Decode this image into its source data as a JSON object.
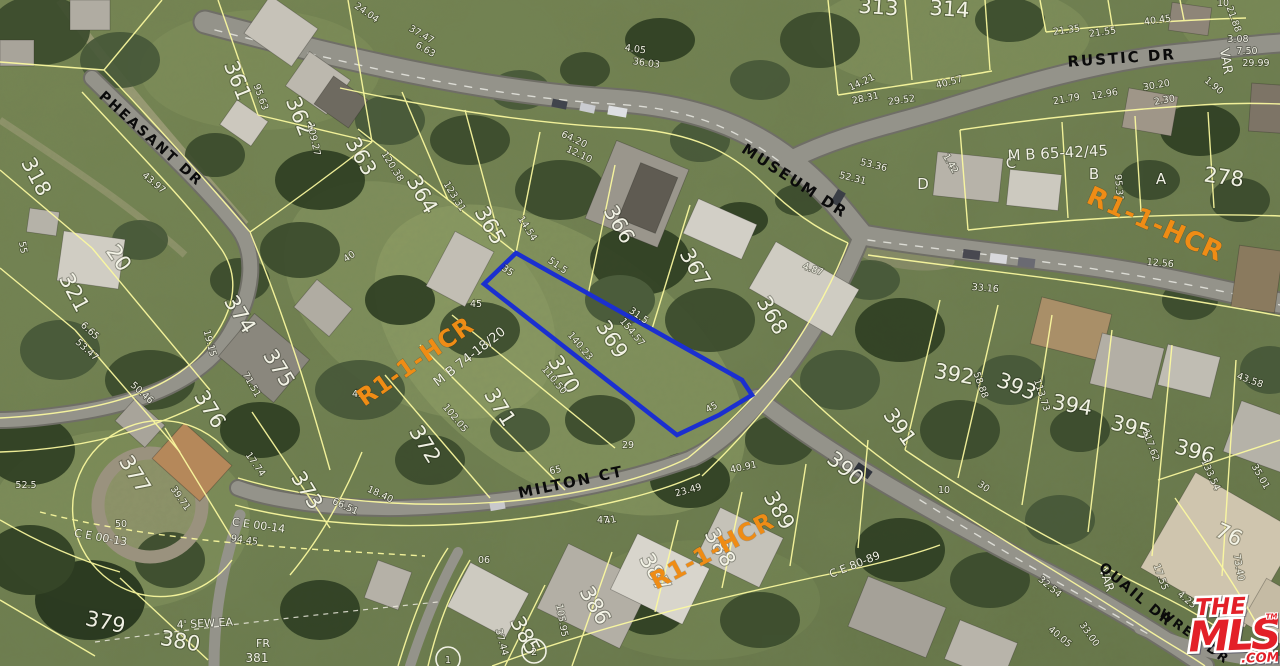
{
  "map": {
    "colors": {
      "parcel_line": "#fdfba0",
      "highlight_outline": "#1b2fd0",
      "zoning_text": "#ef8c15",
      "street_text": "#0b0b0b",
      "dimension_text": "#f2f2e6"
    },
    "streets": [
      [
        "PHEASANT DR",
        148,
        142,
        42,
        14
      ],
      [
        "RUSTIC DR",
        1122,
        63,
        -4,
        15
      ],
      [
        "MUSEUM DR",
        792,
        185,
        33,
        15
      ],
      [
        "MILTON CT",
        572,
        487,
        -12,
        15
      ],
      [
        "QUAIL DR",
        1133,
        598,
        40,
        14
      ],
      [
        "WREN DR",
        1192,
        640,
        36,
        13
      ]
    ],
    "zoning": [
      [
        "R1-1-HCR",
        1152,
        232,
        24,
        26
      ],
      [
        "R1-1-HCR",
        420,
        368,
        -35,
        24
      ],
      [
        "R1-1-HCR",
        716,
        558,
        -28,
        24
      ]
    ],
    "lot_numbers": [
      [
        "318",
        30,
        180,
        62
      ],
      [
        "20",
        113,
        262,
        55
      ],
      [
        "321",
        68,
        296,
        62
      ],
      [
        "361",
        231,
        83,
        68
      ],
      [
        "362",
        293,
        119,
        68
      ],
      [
        "363",
        355,
        160,
        60
      ],
      [
        "364",
        416,
        198,
        60
      ],
      [
        "365",
        484,
        229,
        60
      ],
      [
        "366",
        613,
        228,
        60
      ],
      [
        "367",
        689,
        271,
        60
      ],
      [
        "368",
        766,
        319,
        60
      ],
      [
        "369",
        606,
        343,
        58
      ],
      [
        "370",
        558,
        378,
        58
      ],
      [
        "371",
        494,
        411,
        58
      ],
      [
        "372",
        419,
        448,
        58
      ],
      [
        "373",
        301,
        494,
        58
      ],
      [
        "374",
        234,
        318,
        58
      ],
      [
        "375",
        273,
        372,
        58
      ],
      [
        "376",
        204,
        413,
        58
      ],
      [
        "377",
        129,
        478,
        58
      ],
      [
        "379",
        104,
        629,
        12
      ],
      [
        "380",
        179,
        648,
        10
      ],
      [
        "385",
        519,
        639,
        62
      ],
      [
        "386",
        589,
        609,
        60
      ],
      [
        "387",
        649,
        576,
        60
      ],
      [
        "388",
        714,
        551,
        60
      ],
      [
        "389",
        773,
        514,
        60
      ],
      [
        "390",
        841,
        474,
        40
      ],
      [
        "391",
        894,
        431,
        55
      ],
      [
        "392",
        953,
        381,
        10
      ],
      [
        "393",
        1014,
        393,
        22
      ],
      [
        "394",
        1071,
        412,
        10
      ],
      [
        "395",
        1129,
        434,
        15
      ],
      [
        "396",
        1193,
        458,
        15
      ],
      [
        "313",
        878,
        14,
        4
      ],
      [
        "314",
        949,
        16,
        4
      ],
      [
        "278",
        1223,
        184,
        8
      ],
      [
        "76",
        1226,
        541,
        25
      ]
    ],
    "letters": [
      [
        "D",
        923,
        189
      ],
      [
        "C",
        1011,
        168
      ],
      [
        "B",
        1094,
        179
      ],
      [
        "A",
        1161,
        184
      ]
    ],
    "annotations": [
      [
        "VAR",
        1222,
        62,
        80,
        13
      ],
      [
        "VAR",
        1103,
        581,
        72,
        12
      ],
      [
        "M B 65-42/45",
        1058,
        158,
        -3,
        15
      ],
      [
        "M B 74-18/20",
        472,
        360,
        -38,
        13
      ],
      [
        "C E 00-13",
        100,
        541,
        10,
        11
      ],
      [
        "C E 00-14",
        258,
        529,
        8,
        11
      ],
      [
        "4' SEW EA",
        205,
        627,
        -3,
        11
      ],
      [
        "C E 80-89",
        856,
        568,
        -22,
        11
      ],
      [
        "FR",
        263,
        647,
        0,
        11
      ],
      [
        "381",
        257,
        662,
        0,
        12
      ]
    ],
    "dimensions": [
      [
        "21.35",
        1067,
        33,
        -8
      ],
      [
        "21.55",
        1103,
        35,
        -8
      ],
      [
        "40.45",
        1158,
        23,
        -8
      ],
      [
        "10",
        1223,
        6,
        0
      ],
      [
        "21.88",
        1231,
        20,
        70
      ],
      [
        "30.20",
        1157,
        88,
        -10
      ],
      [
        "12.96",
        1105,
        97,
        -10
      ],
      [
        "21.79",
        1067,
        102,
        -10
      ],
      [
        "2.30",
        1165,
        103,
        -10
      ],
      [
        "1.90",
        1212,
        88,
        40
      ],
      [
        "14.21",
        863,
        85,
        -25
      ],
      [
        "28.31",
        866,
        101,
        -12
      ],
      [
        "29.52",
        902,
        103,
        -8
      ],
      [
        "40.57",
        950,
        85,
        -15
      ],
      [
        "24.04",
        365,
        15,
        35
      ],
      [
        "37.47",
        420,
        37,
        30
      ],
      [
        "6.63",
        424,
        52,
        30
      ],
      [
        "4.05",
        635,
        52,
        8
      ],
      [
        "36.03",
        646,
        66,
        8
      ],
      [
        "3.08",
        1238,
        42,
        0
      ],
      [
        "7.50",
        1247,
        54,
        0
      ],
      [
        "29.99",
        1256,
        66,
        0
      ],
      [
        "95.63",
        258,
        98,
        70
      ],
      [
        "109.27",
        311,
        140,
        78
      ],
      [
        "43.97",
        152,
        185,
        40
      ],
      [
        "55",
        20,
        248,
        80
      ],
      [
        "6.65",
        88,
        333,
        42
      ],
      [
        "53.47",
        85,
        352,
        42
      ],
      [
        "50.46",
        140,
        395,
        42
      ],
      [
        "120.38",
        390,
        168,
        58
      ],
      [
        "123.31",
        452,
        198,
        58
      ],
      [
        "14.54",
        525,
        230,
        58
      ],
      [
        "64.20",
        573,
        142,
        25
      ],
      [
        "12.10",
        578,
        157,
        25
      ],
      [
        "53.36",
        873,
        168,
        14
      ],
      [
        "52.31",
        852,
        181,
        14
      ],
      [
        "1.42",
        948,
        165,
        60
      ],
      [
        "4.87",
        812,
        272,
        20
      ],
      [
        "95.31",
        1116,
        188,
        85
      ],
      [
        "12.56",
        1160,
        266,
        5
      ],
      [
        "33.16",
        985,
        291,
        5
      ],
      [
        "51.5",
        556,
        268,
        35
      ],
      [
        "31.5",
        637,
        318,
        35
      ],
      [
        "154.57",
        630,
        334,
        50
      ],
      [
        "140.23",
        578,
        348,
        50
      ],
      [
        "110.50",
        552,
        382,
        50
      ],
      [
        "102.05",
        453,
        420,
        50
      ],
      [
        "45",
        476,
        307,
        0
      ],
      [
        "45",
        713,
        410,
        -30
      ],
      [
        "45",
        358,
        397,
        0
      ],
      [
        "35",
        506,
        273,
        35
      ],
      [
        "40",
        351,
        259,
        -35
      ],
      [
        "19.15",
        207,
        344,
        75
      ],
      [
        "71.51",
        249,
        386,
        60
      ],
      [
        "17.74",
        253,
        466,
        55
      ],
      [
        "39.71",
        178,
        500,
        55
      ],
      [
        "50",
        121,
        527,
        0
      ],
      [
        "52.5",
        26,
        488,
        0
      ],
      [
        "94.45",
        244,
        543,
        8
      ],
      [
        "65",
        556,
        473,
        -12
      ],
      [
        "41",
        611,
        523,
        -12
      ],
      [
        "66.51",
        344,
        509,
        25
      ],
      [
        "18.40",
        379,
        497,
        25
      ],
      [
        "40.91",
        744,
        470,
        -12
      ],
      [
        "23.49",
        689,
        493,
        -15
      ],
      [
        "105.95",
        559,
        621,
        80
      ],
      [
        "37.44",
        499,
        643,
        75
      ],
      [
        "06",
        484,
        563,
        0
      ],
      [
        "47",
        603,
        523,
        0
      ],
      [
        "29",
        628,
        448,
        0
      ],
      [
        "58.88",
        978,
        386,
        70
      ],
      [
        "113.73",
        1039,
        396,
        72
      ],
      [
        "117.62",
        1148,
        446,
        70
      ],
      [
        "133.54",
        1208,
        476,
        65
      ],
      [
        "43.58",
        1249,
        383,
        20
      ],
      [
        "35.01",
        1258,
        478,
        60
      ],
      [
        "10",
        944,
        493,
        0
      ],
      [
        "30",
        982,
        489,
        35
      ],
      [
        "73.40",
        1236,
        568,
        80
      ],
      [
        "17.55",
        1158,
        578,
        70
      ],
      [
        "33.00",
        1087,
        636,
        55
      ],
      [
        "32.54",
        1048,
        589,
        40
      ],
      [
        "40.05",
        1058,
        639,
        40
      ],
      [
        "4.25",
        1185,
        602,
        40
      ]
    ],
    "markers": [
      [
        "1",
        448,
        659
      ],
      [
        "2",
        534,
        651
      ]
    ]
  },
  "logo": {
    "the": "THE",
    "mls": "MLS",
    "tm": "TM",
    "com": ".COM"
  }
}
